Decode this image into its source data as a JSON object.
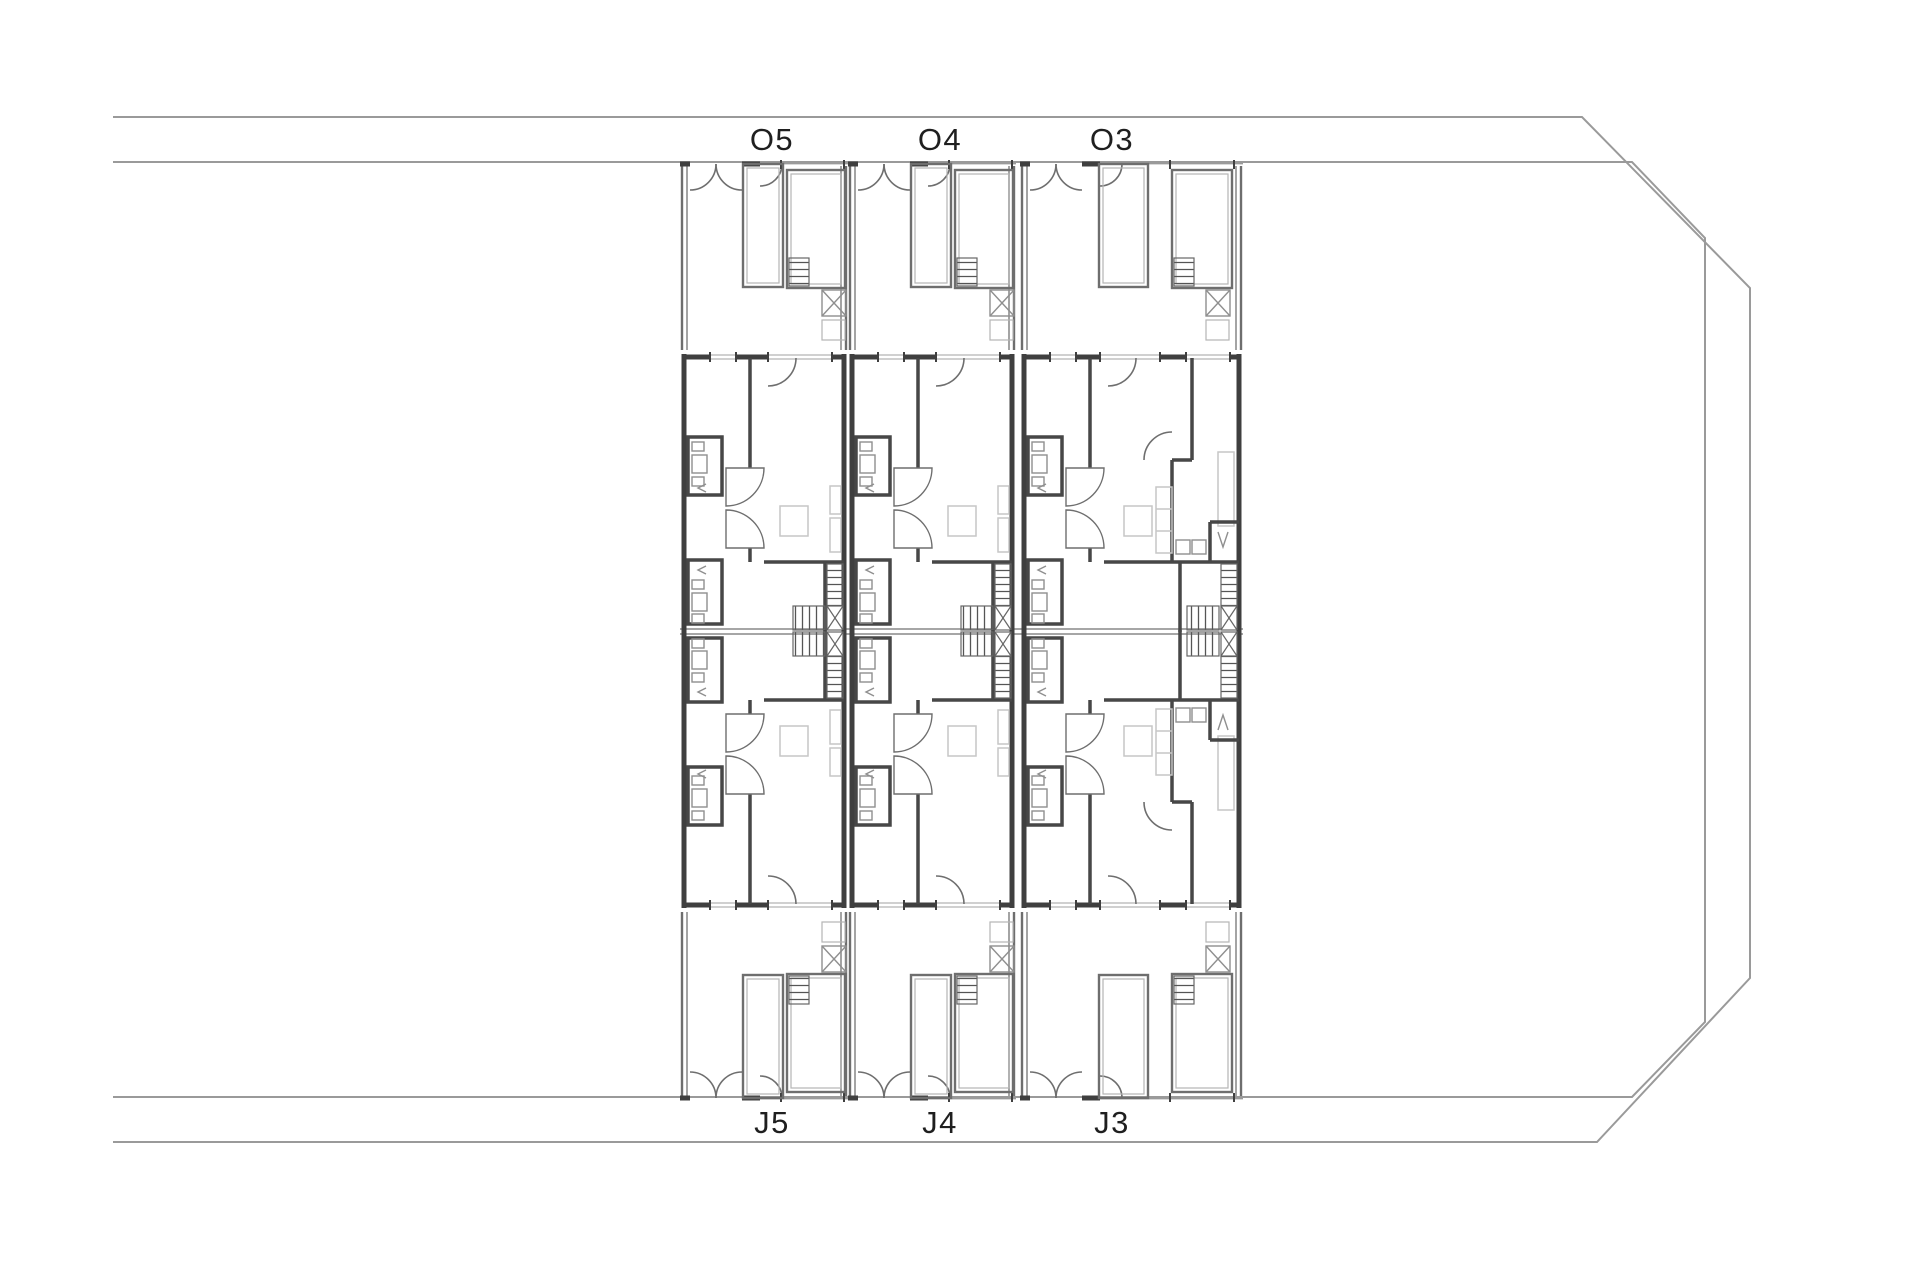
{
  "plan": {
    "type": "architectural-site-floor-plan",
    "top_unit_labels": [
      "O5",
      "O4",
      "O3"
    ],
    "bottom_unit_labels": [
      "J5",
      "J4",
      "J3"
    ]
  },
  "colors": {
    "background": "#ffffff",
    "boundary_line": "#9a9a9a",
    "wall_dark": "#3f3f3f",
    "partition_line": "#6e6e6e",
    "thin_line": "#9a9a9a",
    "furniture_line": "#c6c6c6",
    "stair_hatch": "#555555",
    "label_text": "#1f1f1f"
  }
}
